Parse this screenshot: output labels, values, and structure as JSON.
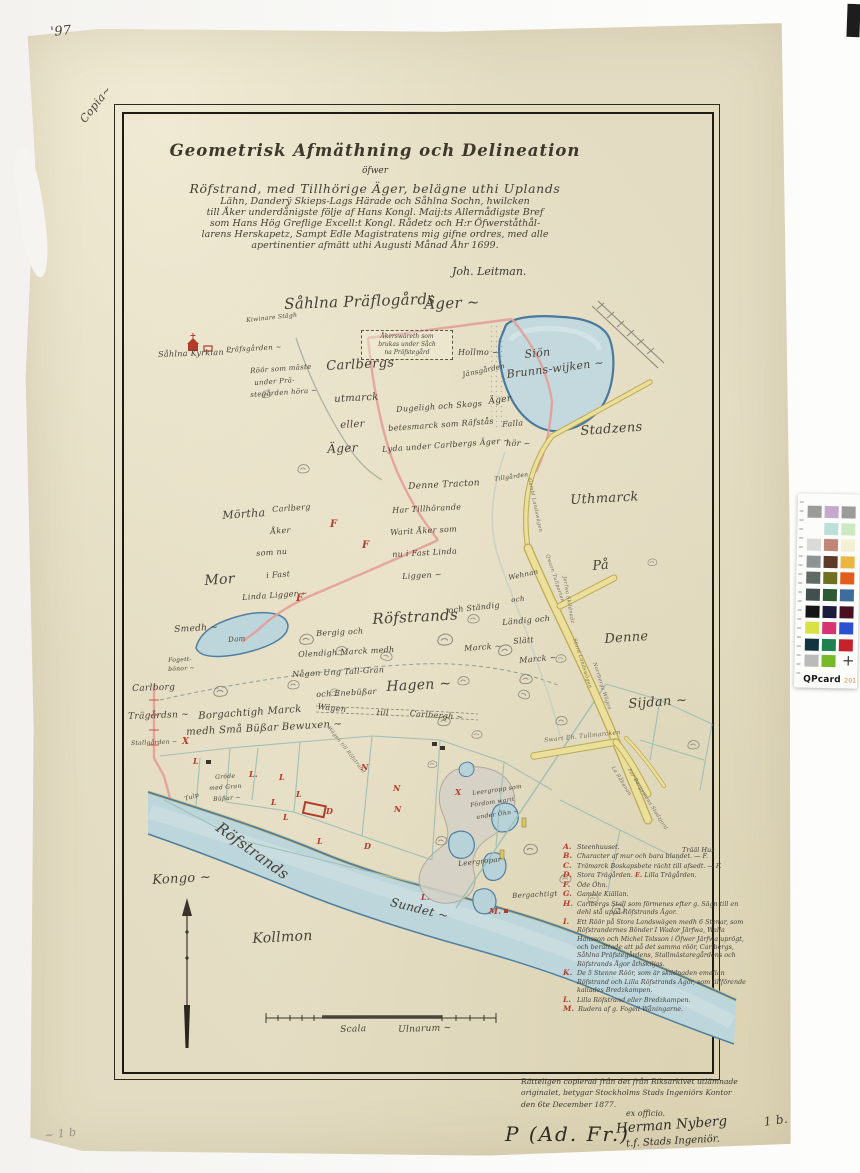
{
  "colors": {
    "ink": "#464034",
    "red": "#b23b2a",
    "pencil": "#968e80",
    "faint": "#6f695d",
    "paper": "#e3dcc2",
    "water_fill": "#bdd6db",
    "water_edge": "#4f7fa0",
    "road_fill": "#ecdf9b",
    "road_edge": "#b9ab54",
    "boundary_pink": "#e39f98",
    "field_line": "#9fc0b5"
  },
  "title_block": {
    "title": "Geometrisk Afmäthning och Delineation",
    "subtitle": "öfwer",
    "body_lines": [
      "Röfstrand, med Tillhörige Äger, belägne uthi Uplands",
      "Lähn, Danderÿ Skieps-Lags Härade och Såhlna Sochn, hwilcken",
      "till Åker underdånigste följe af Hans Kongl. Maij:ts Allernådigste Bref",
      "som Hans Hög Greflige Excell:t Kongl. Rådetz och H:r Öfwerståthål-",
      "larens Herskapetz, Sampt Edle Magistratens mig gifne ordres, med alle",
      "apertinentier afmätt uthi Augusti Månad Åhr 1699."
    ],
    "signature": "Joh. Leitman."
  },
  "note_box": {
    "lines": [
      "Åkerswäreth som",
      "brukas under Såch",
      "na Präfstegård"
    ]
  },
  "map_labels": [
    {
      "n": "corner-number",
      "t": "'97",
      "x": 50,
      "y": 26,
      "s": 13,
      "r": -5
    },
    {
      "n": "copia-note",
      "t": "Copia~",
      "x": 78,
      "y": 118,
      "s": 11,
      "r": -52
    },
    {
      "n": "label-prastegards-ager",
      "t": "Såhlna Präflogårds",
      "x": 284,
      "y": 297,
      "s": 15,
      "r": -2
    },
    {
      "t": "Äger ~",
      "x": 424,
      "y": 297,
      "s": 15,
      "r": -2
    },
    {
      "n": "label-sahlna-kyrkia",
      "t": "Såhlna Kyrkian ~",
      "x": 158,
      "y": 351,
      "s": 8,
      "r": -2
    },
    {
      "t": "Präfsgården ~",
      "x": 226,
      "y": 347,
      "s": 7,
      "r": -3
    },
    {
      "t": "Kiwinare Stägh",
      "x": 246,
      "y": 318,
      "s": 6,
      "r": -6
    },
    {
      "t": "Röör som mäste",
      "x": 250,
      "y": 368,
      "s": 7,
      "r": -4
    },
    {
      "t": "under Prä-",
      "x": 254,
      "y": 380,
      "s": 7,
      "r": -4
    },
    {
      "t": "stegården höra ~",
      "x": 250,
      "y": 392,
      "s": 7,
      "r": -4
    },
    {
      "n": "label-carlbergs",
      "t": "Carlbergs",
      "x": 326,
      "y": 360,
      "s": 13,
      "r": -3
    },
    {
      "t": "utmarck",
      "x": 334,
      "y": 395,
      "s": 10,
      "r": -3
    },
    {
      "t": "eller",
      "x": 340,
      "y": 421,
      "s": 10,
      "r": -3
    },
    {
      "t": "Äger",
      "x": 327,
      "y": 443,
      "s": 12,
      "r": -3
    },
    {
      "t": "Hollmo ~",
      "x": 458,
      "y": 349,
      "s": 8,
      "r": 0
    },
    {
      "t": "Jänsgården",
      "x": 462,
      "y": 372,
      "s": 7,
      "r": -12
    },
    {
      "t": "Dugeligh och Skogs",
      "x": 396,
      "y": 406,
      "s": 8,
      "r": -4
    },
    {
      "t": "betesmarck som Räfstås",
      "x": 388,
      "y": 425,
      "s": 8,
      "r": -4
    },
    {
      "t": "Lyda under Carlbergs Äger ~",
      "x": 382,
      "y": 446,
      "s": 8,
      "r": -4
    },
    {
      "t": "Äger",
      "x": 488,
      "y": 398,
      "s": 9,
      "r": -8
    },
    {
      "t": "Falla",
      "x": 502,
      "y": 421,
      "s": 8,
      "r": -5
    },
    {
      "t": "hör ~",
      "x": 506,
      "y": 440,
      "s": 8,
      "r": 0
    },
    {
      "n": "label-lake",
      "t": "Siön",
      "x": 524,
      "y": 349,
      "s": 11,
      "r": -6
    },
    {
      "t": "Brunns-wijken ~",
      "x": 506,
      "y": 369,
      "s": 11,
      "r": -7
    },
    {
      "n": "label-stadzens",
      "t": "Stadzens",
      "x": 580,
      "y": 425,
      "s": 13,
      "r": -4
    },
    {
      "t": "Uthmarck",
      "x": 570,
      "y": 494,
      "s": 13,
      "r": -3
    },
    {
      "t": "På",
      "x": 592,
      "y": 560,
      "s": 13,
      "r": -5
    },
    {
      "t": "Denne",
      "x": 604,
      "y": 633,
      "s": 13,
      "r": -4
    },
    {
      "t": "Sijdan ~",
      "x": 628,
      "y": 698,
      "s": 13,
      "r": -4
    },
    {
      "t": "Tillgården",
      "x": 494,
      "y": 477,
      "s": 6,
      "r": -8
    },
    {
      "t": "Denne Tracton",
      "x": 408,
      "y": 483,
      "s": 9,
      "r": -3
    },
    {
      "t": "Har Tillhörande",
      "x": 392,
      "y": 507,
      "s": 8,
      "r": -3
    },
    {
      "t": "Warit Åker som",
      "x": 390,
      "y": 529,
      "s": 8,
      "r": -3
    },
    {
      "t": "nu i Fast Linda",
      "x": 392,
      "y": 551,
      "s": 8,
      "r": -3
    },
    {
      "t": "Liggen ~",
      "x": 402,
      "y": 573,
      "s": 8,
      "r": -3
    },
    {
      "t": "Mörtha",
      "x": 222,
      "y": 510,
      "s": 11,
      "r": -4
    },
    {
      "t": "Carlberg",
      "x": 272,
      "y": 506,
      "s": 8,
      "r": -4
    },
    {
      "t": "Åker",
      "x": 270,
      "y": 528,
      "s": 8,
      "r": -4
    },
    {
      "t": "som nu",
      "x": 256,
      "y": 550,
      "s": 8,
      "r": -4
    },
    {
      "t": "i Fast",
      "x": 266,
      "y": 572,
      "s": 8,
      "r": -4
    },
    {
      "t": "Linda Ligger ~",
      "x": 242,
      "y": 594,
      "s": 8,
      "r": -4
    },
    {
      "t": "Mor",
      "x": 204,
      "y": 574,
      "s": 14,
      "r": -4
    },
    {
      "t": "Smedh ~",
      "x": 174,
      "y": 626,
      "s": 9,
      "r": -3
    },
    {
      "t": "Dam",
      "x": 228,
      "y": 637,
      "s": 7,
      "r": -5
    },
    {
      "t": "Fogett-",
      "x": 168,
      "y": 658,
      "s": 6,
      "r": -3
    },
    {
      "t": "bönor ~",
      "x": 168,
      "y": 667,
      "s": 6,
      "r": -3
    },
    {
      "n": "label-rofstrands",
      "t": "Röfstrands",
      "x": 372,
      "y": 612,
      "s": 15,
      "r": -3
    },
    {
      "t": "och Ständig",
      "x": 448,
      "y": 607,
      "s": 8,
      "r": -6
    },
    {
      "t": "Marck ~",
      "x": 464,
      "y": 645,
      "s": 8,
      "r": -4
    },
    {
      "t": "Bergig och",
      "x": 316,
      "y": 630,
      "s": 8,
      "r": -3
    },
    {
      "t": "Olendigh Marck medh",
      "x": 298,
      "y": 651,
      "s": 8,
      "r": -3
    },
    {
      "t": "Någon Ung Tall-Gran",
      "x": 292,
      "y": 671,
      "s": 8,
      "r": -3
    },
    {
      "t": "och Enebüßar",
      "x": 316,
      "y": 691,
      "s": 8,
      "r": -3
    },
    {
      "n": "label-hagen",
      "t": "Hagen ~",
      "x": 386,
      "y": 680,
      "s": 14,
      "r": -3
    },
    {
      "t": "Wägen",
      "x": 318,
      "y": 703,
      "s": 8,
      "r": 6
    },
    {
      "t": "till",
      "x": 377,
      "y": 709,
      "s": 8,
      "r": 4
    },
    {
      "t": "Carlbergh ~",
      "x": 410,
      "y": 710,
      "s": 8,
      "r": 4
    },
    {
      "t": "Wehnan",
      "x": 508,
      "y": 575,
      "s": 7,
      "r": -12
    },
    {
      "t": "och",
      "x": 511,
      "y": 597,
      "s": 7,
      "r": -5
    },
    {
      "t": "Ländig och",
      "x": 502,
      "y": 619,
      "s": 8,
      "r": -5
    },
    {
      "t": "Slätt",
      "x": 513,
      "y": 638,
      "s": 8,
      "r": -5
    },
    {
      "t": "Marck ~",
      "x": 519,
      "y": 657,
      "s": 8,
      "r": -5
    },
    {
      "t": "Carlborg",
      "x": 132,
      "y": 685,
      "s": 9,
      "r": -2
    },
    {
      "t": "Trägårdsn ~",
      "x": 128,
      "y": 713,
      "s": 9,
      "r": -2
    },
    {
      "t": "Stallgården ~",
      "x": 131,
      "y": 741,
      "s": 6,
      "r": -2
    },
    {
      "t": "Borgachtigh Marck",
      "x": 198,
      "y": 712,
      "s": 10,
      "r": -4
    },
    {
      "t": "medh Små Büßar Bewuxen ~",
      "x": 186,
      "y": 728,
      "s": 10,
      "r": -3
    },
    {
      "t": "Gröde",
      "x": 215,
      "y": 775,
      "s": 6,
      "r": -4
    },
    {
      "t": "med Gran",
      "x": 209,
      "y": 786,
      "s": 6,
      "r": -4
    },
    {
      "t": "Büßar ~",
      "x": 213,
      "y": 797,
      "s": 6,
      "r": -4
    },
    {
      "t": "Tulp",
      "x": 184,
      "y": 797,
      "s": 6,
      "r": -18
    },
    {
      "n": "label-river-rofstrands",
      "t": "Röfstrands",
      "x": 222,
      "y": 820,
      "s": 15,
      "r": 36
    },
    {
      "t": "Kongo ~",
      "x": 152,
      "y": 874,
      "s": 13,
      "r": -3
    },
    {
      "t": "Kollmon",
      "x": 252,
      "y": 932,
      "s": 14,
      "r": -3
    },
    {
      "n": "label-sundet",
      "t": "Sundet ~",
      "x": 392,
      "y": 896,
      "s": 12,
      "r": 14
    },
    {
      "t": "Leergropp som",
      "x": 472,
      "y": 791,
      "s": 6,
      "r": -8
    },
    {
      "t": "Fördom warit",
      "x": 470,
      "y": 803,
      "s": 6,
      "r": -8
    },
    {
      "t": "under Öhn ~",
      "x": 476,
      "y": 815,
      "s": 6,
      "r": -8
    },
    {
      "t": "Leergropar",
      "x": 458,
      "y": 861,
      "s": 7,
      "r": -6
    },
    {
      "t": "Bergachtigt",
      "x": 512,
      "y": 893,
      "s": 7,
      "r": -3
    },
    {
      "n": "road-label",
      "t": "Gambl Landswägen",
      "x": 531,
      "y": 478,
      "s": 5,
      "r": 78,
      "c": "faint"
    },
    {
      "n": "road-label",
      "t": "Qwarn Tullporten",
      "x": 549,
      "y": 554,
      "s": 5,
      "r": 72,
      "c": "faint"
    },
    {
      "n": "road-label",
      "t": "Jerfwa Skildnadz",
      "x": 566,
      "y": 576,
      "s": 5,
      "r": 80,
      "c": "faint"
    },
    {
      "n": "road-label",
      "t": "Stora Landswägen",
      "x": 576,
      "y": 638,
      "s": 5,
      "r": 72,
      "c": "faint"
    },
    {
      "n": "road-label",
      "t": "Norrbergs Wägen",
      "x": 596,
      "y": 662,
      "s": 5,
      "r": 72,
      "c": "faint"
    },
    {
      "n": "road-label",
      "t": "Swart Eh. Tullmarcken",
      "x": 544,
      "y": 738,
      "s": 6,
      "r": -6,
      "c": "faint"
    },
    {
      "n": "road-label",
      "t": "La Råbanan",
      "x": 614,
      "y": 766,
      "s": 5,
      "r": 58,
      "c": "faint"
    },
    {
      "n": "road-label",
      "t": "Por Bergsmans Stadzjord",
      "x": 630,
      "y": 768,
      "s": 5,
      "r": 58,
      "c": "faint"
    },
    {
      "n": "road-label",
      "t": "Wägen till Röfstrand",
      "x": 330,
      "y": 726,
      "s": 5,
      "r": 52,
      "c": "faint"
    },
    {
      "n": "red-marker",
      "t": "F",
      "x": 330,
      "y": 520,
      "s": 10,
      "c": "red"
    },
    {
      "n": "red-marker",
      "t": "F",
      "x": 362,
      "y": 541,
      "s": 10,
      "c": "red"
    },
    {
      "n": "red-marker",
      "t": "F",
      "x": 296,
      "y": 594,
      "s": 10,
      "c": "red"
    },
    {
      "n": "red-marker",
      "t": "X",
      "x": 182,
      "y": 738,
      "s": 9,
      "c": "red"
    },
    {
      "n": "red-marker",
      "t": "L",
      "x": 193,
      "y": 757,
      "s": 8,
      "c": "red"
    },
    {
      "n": "red-marker",
      "t": "L.",
      "x": 249,
      "y": 770,
      "s": 8,
      "c": "red"
    },
    {
      "n": "red-marker",
      "t": "L",
      "x": 279,
      "y": 773,
      "s": 8,
      "c": "red"
    },
    {
      "n": "red-marker",
      "t": "L",
      "x": 296,
      "y": 790,
      "s": 8,
      "c": "red"
    },
    {
      "n": "red-marker",
      "t": "L",
      "x": 271,
      "y": 798,
      "s": 8,
      "c": "red"
    },
    {
      "n": "red-marker",
      "t": "L",
      "x": 283,
      "y": 813,
      "s": 8,
      "c": "red"
    },
    {
      "n": "red-marker",
      "t": "L",
      "x": 317,
      "y": 837,
      "s": 8,
      "c": "red"
    },
    {
      "n": "red-marker",
      "t": "N",
      "x": 361,
      "y": 763,
      "s": 8,
      "c": "red"
    },
    {
      "n": "red-marker",
      "t": "N",
      "x": 393,
      "y": 784,
      "s": 8,
      "c": "red"
    },
    {
      "n": "red-marker",
      "t": "N",
      "x": 394,
      "y": 805,
      "s": 8,
      "c": "red"
    },
    {
      "n": "red-marker",
      "t": "D",
      "x": 326,
      "y": 807,
      "s": 8,
      "c": "red"
    },
    {
      "n": "red-marker",
      "t": "D",
      "x": 364,
      "y": 842,
      "s": 8,
      "c": "red"
    },
    {
      "n": "red-marker",
      "t": "X",
      "x": 455,
      "y": 788,
      "s": 8,
      "c": "red"
    },
    {
      "n": "red-marker",
      "t": "L.",
      "x": 421,
      "y": 893,
      "s": 8,
      "c": "red"
    },
    {
      "n": "red-marker",
      "t": "M.",
      "x": 489,
      "y": 907,
      "s": 8,
      "c": "red"
    },
    {
      "n": "scale-label",
      "t": "Scala",
      "x": 340,
      "y": 1026,
      "s": 9,
      "r": -2
    },
    {
      "n": "scale-label",
      "t": "Ulnarum ~",
      "x": 398,
      "y": 1026,
      "s": 9,
      "r": -2
    },
    {
      "n": "folio-number",
      "t": "1 b.",
      "x": 763,
      "y": 1116,
      "s": 12,
      "r": -8
    },
    {
      "n": "pencil-note",
      "t": "~ 1 b",
      "x": 44,
      "y": 1130,
      "s": 11,
      "r": -6,
      "c": "pencil"
    }
  ],
  "legend": {
    "side_note": "Trääl Hus",
    "items": [
      {
        "letter": "A.",
        "text": "Steenhuuset."
      },
      {
        "letter": "B.",
        "text": "Character af mur och bara blandet. — F."
      },
      {
        "letter": "C.",
        "text": "Trämarck Boskapsbete rächt till afsedt. — F."
      },
      {
        "letter": "D.",
        "text": "Stora Trägården.",
        "extra_letter": "E.",
        "extra_text": "Lilla Trägården."
      },
      {
        "letter": "F.",
        "text": "Öde Öhn."
      },
      {
        "letter": "G.",
        "text": "Gamble Kiällan."
      },
      {
        "letter": "H.",
        "text": "Carlbergs Stall som förmenes efter g. Sägn till en dehl stå uppå Röfstrands Ägor."
      },
      {
        "letter": "I.",
        "text": "Ett Röör på Stora Landswägen medh 6 Stenar, som Röfstrandernes Bönder I Wador Järfwa, Walla Hansson och Michel Tolsson i Öfwer Järfwa uprögt, och berättade att på det samma röör, Carlbergs, Såhlna Präfstegårdens, Stallmästaregårdens och Röfstrands Ägor åthskiljas."
      },
      {
        "letter": "K.",
        "text": "De 5 Stenne Röör, som är skildnaden emellan Röfstrand och Lilla Röfstrands Ägor, som tillförende kallades Bredzkampen."
      },
      {
        "letter": "L.",
        "text": "Lilla Röfstrand eller Bredzkampen."
      },
      {
        "letter": "M.",
        "text": "Rudera af g. Fogell Wåningarne."
      }
    ]
  },
  "certification": {
    "lines": [
      "Rätteligen copierad från det från Riksarkivet utlämnade",
      "originalet, betygar Stockholms Stads Ingeniörs Kontor",
      "den 6te December 1877."
    ],
    "ex_officio": "ex officio.",
    "signature_name": "Herman Nyberg",
    "signature_title": "t.f. Stads Ingeniör.",
    "annotation": "P (Ad. Fr.)"
  },
  "qpcard": {
    "brand": "QPcard",
    "model": "201",
    "cross": "+",
    "swatches": [
      [
        "#9b9b9b",
        "#c4a9cd",
        "#9b9b9b"
      ],
      [
        null,
        "#bbdfd9",
        "#cde9c0"
      ],
      [
        "#dadada",
        "#c28678",
        "#f5efd3"
      ],
      [
        "#8e9393",
        "#5e3a2b",
        "#ebb541"
      ],
      [
        "#5f6a64",
        "#6f7022",
        "#e25c1d"
      ],
      [
        "#41504f",
        "#2d5a33",
        "#3e6c9c"
      ],
      [
        "#151515",
        "#1b1b40",
        "#491021"
      ],
      [
        "#d9e147",
        "#d63473",
        "#2b50d1"
      ],
      [
        "#11343f",
        "#1f8150",
        "#c5222c"
      ],
      [
        "#bababa",
        "#77b92b",
        null
      ]
    ]
  }
}
